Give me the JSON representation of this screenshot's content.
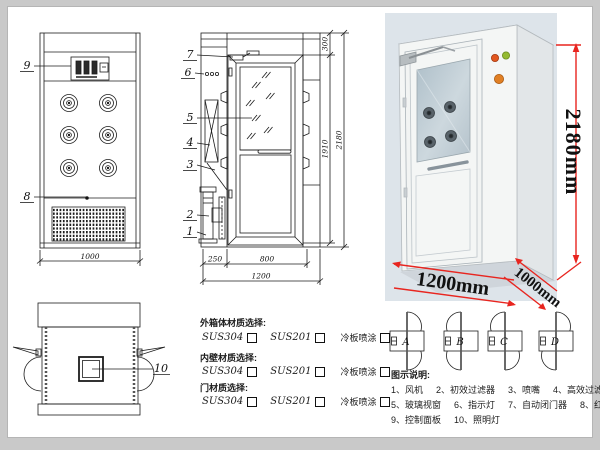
{
  "colors": {
    "dim_red": "#e8251f",
    "photo_bg": "#dde4ea",
    "line": "#1c1c1c"
  },
  "drawing": {
    "front_view": {
      "callout_control_panel": "9",
      "callout_grille": "8",
      "width_dim": "1000"
    },
    "side_view": {
      "callouts": [
        "7",
        "6",
        "5",
        "4",
        "3",
        "2",
        "1"
      ],
      "dim_top": "300",
      "dim_door_height": "1910",
      "dim_total_height": "2180",
      "dim_left": "250",
      "dim_door_width": "800",
      "dim_total_width": "1200"
    },
    "top_view": {
      "callout_ceiling_lamp": "10"
    }
  },
  "photo": {
    "height_label": "2180mm",
    "width_label": "1200mm",
    "depth_label": "1000mm"
  },
  "materials": {
    "sections": [
      {
        "title": "外箱体材质选择:",
        "options": [
          "SUS304",
          "SUS201",
          "冷板喷涂"
        ]
      },
      {
        "title": "内壁材质选择:",
        "options": [
          "SUS304",
          "SUS201",
          "冷板喷涂"
        ]
      },
      {
        "title": "门材质选择:",
        "options": [
          "SUS304",
          "SUS201",
          "冷板喷涂"
        ]
      }
    ]
  },
  "door_configs": {
    "labels": [
      "A",
      "B",
      "C",
      "D"
    ]
  },
  "legend": {
    "title": "图示说明:",
    "rows": [
      [
        "1、风机",
        "2、初效过滤器",
        "3、喷嘴",
        "4、高效过滤器"
      ],
      [
        "5、玻璃视窗",
        "6、指示灯",
        "7、自动闭门器",
        "8、红外线感应器"
      ],
      [
        "9、控制面板",
        "10、照明灯"
      ]
    ]
  }
}
